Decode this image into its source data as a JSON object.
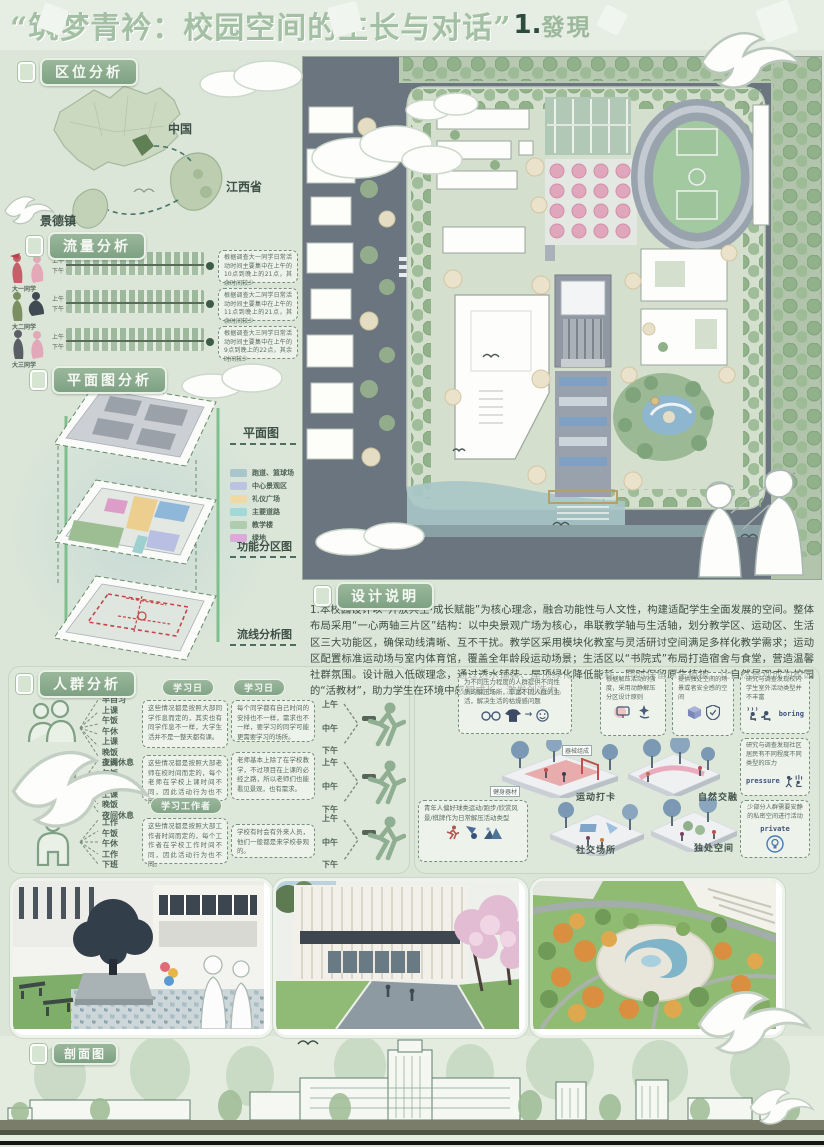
{
  "title": {
    "main": "“筑梦青衿：校园空间的生长与对话”",
    "number": "1.",
    "suffix": "發現"
  },
  "location": {
    "header": "区位分析",
    "china": "中国",
    "province": "江西省",
    "city": "景德镇"
  },
  "flow": {
    "header": "流量分析",
    "rows": [
      {
        "label": "大一同学",
        "am": "上午",
        "pm": "下午",
        "note": "根据调查大一同学日常活动时间主要集中在上午的10点到晚上的21点，其余时间较少"
      },
      {
        "label": "大二同学",
        "am": "上午",
        "pm": "下午",
        "note": "根据调查大二同学日常活动时间主要集中在上午的11点到晚上的21点，其余时间较少"
      },
      {
        "label": "大三同学",
        "am": "上午",
        "pm": "下午",
        "note": "根据调查大三同学日常活动时间主要集中在上午的9点到晚上的22点，其余时间较少"
      }
    ]
  },
  "plan_analysis": {
    "header": "平面图分析",
    "layers": [
      {
        "label": "平面图"
      },
      {
        "label": "功能分区图"
      },
      {
        "label": "流线分析图"
      }
    ],
    "legend": [
      {
        "label": "跑道、篮球场",
        "color": "#a9c6cc"
      },
      {
        "label": "中心景观区",
        "color": "#bcc2e4"
      },
      {
        "label": "礼仪广场",
        "color": "#f0d9a2"
      },
      {
        "label": "主要道路",
        "color": "#a3d8d8"
      },
      {
        "label": "教学楼",
        "color": "#afccae"
      },
      {
        "label": "绿地",
        "color": "#dcaad8"
      }
    ]
  },
  "design_notes": {
    "header": "设计说明",
    "body": "1.本校园设计以“开放共生·成长赋能”为核心理念，融合功能性与人文性，构建适配学生全面发展的空间。整体布局采用“一心两轴三片区”结构：以中央景观广场为核心，串联教学轴与生活轴，划分教学区、运动区、生活区三大功能区，确保动线清晰、互不干扰。教学区采用模块化教室与灵活研讨空间满足多样化教学需求；运动区配置标准运动场与室内体育馆，覆盖全年龄段运动场景；生活区以“书院式”布局打造宿舍与食堂，营造温馨社群氛围。设计融入低碳理念，通过透水铺装、屋顶绿化降低能耗，同时保留原生植被，让自然景观成为校园的“活教材”，助力学生在环境中感知成长、激发创造力。"
  },
  "crowd": {
    "header": "人群分析",
    "tags": [
      "学习日",
      "学习日",
      "学习工作者"
    ],
    "times": [
      "上午",
      "中午",
      "下午"
    ],
    "groups": [
      {
        "schedule": [
          "早自习",
          "上课",
          "午饭",
          "午休",
          "上课",
          "晚饭",
          "夜间休息"
        ],
        "note_left": "这些情况都是按照大部同学作息而定的，其实也有同学作息不一样，大学生活并不是一整天都有课。",
        "note_right": "每个同学都有自己时间的安排也不一样，需求也不一样，要学习的同学可能更需要学习的场所。"
      },
      {
        "schedule": [
          "上课",
          "午饭",
          "午休",
          "上课",
          "晚饭",
          "夜间休息"
        ],
        "note_left": "这些情况都是按照大部老师在校时间而定的，每个老师在学校上课时间不同，因此活动行为也不同。",
        "note_right": "老师基本上除了在学校教学，不过项目在上课的必经之路，所以老师们也能看见景观，也有需求。"
      },
      {
        "schedule": [
          "工作",
          "午饭",
          "午休",
          "工作",
          "下班"
        ],
        "note_left": "这些情况都是按照大部工作者时间而定的，每个工作者在学校工作时间不同，因此活动行为也不同。",
        "note_right": "学校有时会有外来人员，他们一般都是来学校参观的。"
      }
    ],
    "insights": [
      {
        "text": "为不同压力程度的人群提供不同性质的解压场所，丰富不同人群的生活，解决生活的枯燥感问题"
      },
      {
        "text": "根据解压活动的强度，采用动静解压分区设计原则"
      },
      {
        "text": "提供独处空间的场景或者安全感的空间"
      },
      {
        "text": "研究与调查发现校内学生室外活动类型并不丰富",
        "tag": "boring"
      },
      {
        "text": "研究与调查发现社区居民有不同程度不同类型的压力",
        "tag": "pressure"
      },
      {
        "text": "少部分人群需要安静的私密空间进行活动",
        "tag": "private"
      }
    ],
    "youth_note": "青年人偏好球类运动/跑步/欣赏风景/棋牌作为日常解压活动类型",
    "scene_labels": {
      "fitness": "健身器材",
      "equipment": "器械组成",
      "sport": "运动打卡",
      "nature": "自然交融",
      "social": "社交场所",
      "solo": "独处空间"
    }
  },
  "section_drawing": {
    "header": "剖面图"
  }
}
